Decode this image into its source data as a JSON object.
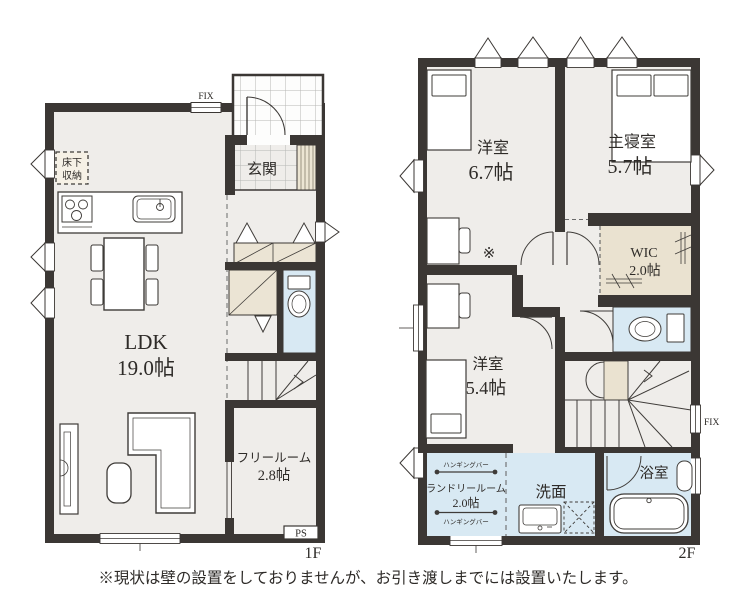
{
  "note": "※現状は壁の設置をしておりませんが、お引き渡しまでには設置いたします。",
  "colors": {
    "wall": "#3B3734",
    "floor": "#EFEDEA",
    "wet_area": "#D8E9F3",
    "closet": "#EBE4D4",
    "storage_beige": "#EAE2D0"
  },
  "floor1": {
    "label": "1F",
    "fix_label": "FIX",
    "rooms": {
      "ldk": {
        "name": "LDK",
        "size": "19.0帖"
      },
      "genkan": {
        "name": "玄関"
      },
      "underfloor": {
        "line1": "床下",
        "line2": "収納"
      },
      "freeroom": {
        "name": "フリールーム",
        "size": "2.8帖"
      },
      "ps": "PS"
    }
  },
  "floor2": {
    "label": "2F",
    "fix_label": "FIX",
    "note_mark": "※",
    "rooms": {
      "bedroom_67": {
        "name": "洋室",
        "size": "6.7帖"
      },
      "main_bedroom": {
        "name": "主寝室",
        "size": "5.7帖"
      },
      "wic": {
        "name": "WIC",
        "size": "2.0帖"
      },
      "bedroom_54": {
        "name": "洋室",
        "size": "5.4帖"
      },
      "laundry": {
        "name": "ランドリールーム",
        "size": "2.0帖",
        "hanging_bar": "ハンギングバー"
      },
      "washroom": {
        "name": "洗面"
      },
      "bathroom": {
        "name": "浴室"
      }
    }
  }
}
